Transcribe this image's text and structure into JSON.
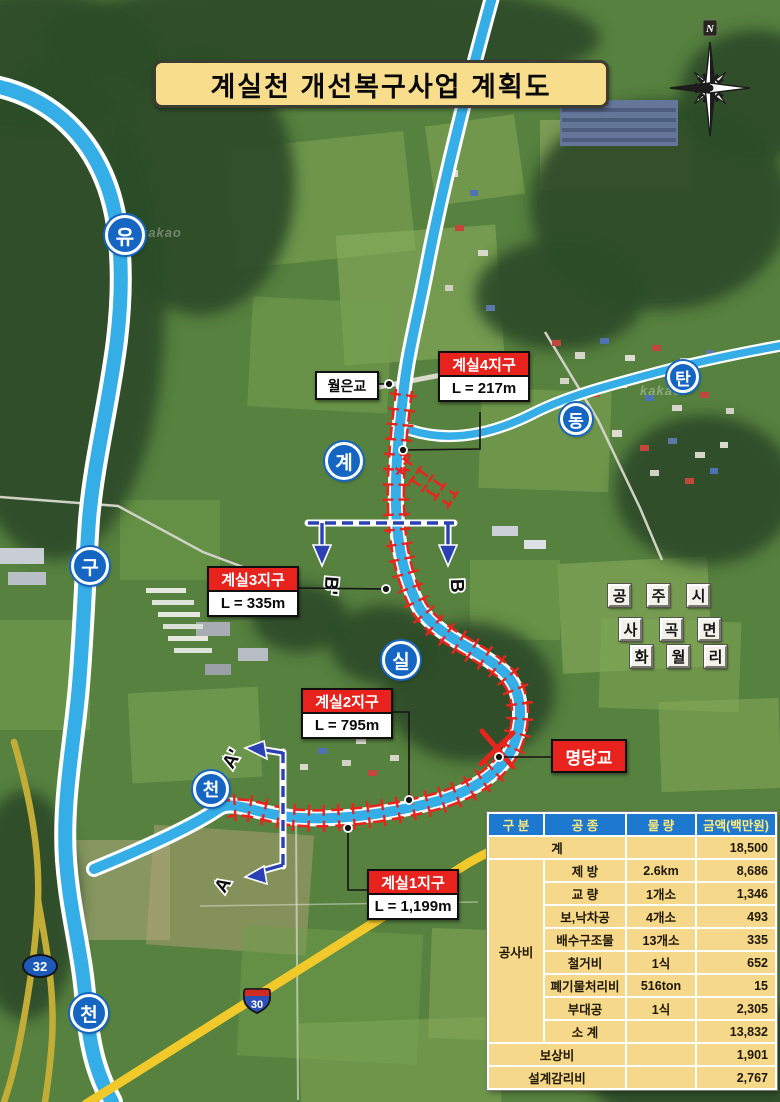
{
  "title": "계실천 개선복구사업 계획도",
  "compass": {
    "north": "N"
  },
  "bridges": {
    "woleun": "월은교",
    "myeongdang": "명당교"
  },
  "sections": [
    {
      "name": "계실4지구",
      "length": "L = 217m"
    },
    {
      "name": "계실3지구",
      "length": "L = 335m"
    },
    {
      "name": "계실2지구",
      "length": "L = 795m"
    },
    {
      "name": "계실1지구",
      "length": "L = 1,199m"
    }
  ],
  "section_markers": {
    "a": "A",
    "a_prime": "A'",
    "b": "B",
    "b_prime": "B'"
  },
  "stream_labels": {
    "left": [
      "유",
      "구",
      "천"
    ],
    "main": [
      "계",
      "실",
      "천"
    ],
    "east": [
      "동",
      "탄"
    ]
  },
  "region": {
    "row1": [
      "공",
      "주",
      "시"
    ],
    "row2": [
      "사",
      "곡",
      "면"
    ],
    "row3": [
      "화",
      "월",
      "리"
    ]
  },
  "routes": {
    "route32": "32",
    "route30": "30"
  },
  "watermark": "kakao",
  "colors": {
    "river": "#35ade7",
    "levee_red": "#e8251d",
    "section_blue": "#2a41b4",
    "table_header_bg": "#1d79cf",
    "table_header_text": "#ffe97c",
    "table_body_bg": "#f5d88a",
    "title_bg": "#f7dd8c",
    "label_red": "#e8231d"
  },
  "table": {
    "headers": [
      "구 분",
      "공 종",
      "물 량",
      "금액(백만원)"
    ],
    "rows": [
      {
        "category": "계",
        "item": "",
        "qty": "",
        "amount": "18,500"
      },
      {
        "category": "공사비",
        "item": "제 방",
        "qty": "2.6km",
        "amount": "8,686"
      },
      {
        "category": "",
        "item": "교 량",
        "qty": "1개소",
        "amount": "1,346"
      },
      {
        "category": "",
        "item": "보,낙차공",
        "qty": "4개소",
        "amount": "493"
      },
      {
        "category": "",
        "item": "배수구조물",
        "qty": "13개소",
        "amount": "335"
      },
      {
        "category": "",
        "item": "철거비",
        "qty": "1식",
        "amount": "652"
      },
      {
        "category": "",
        "item": "폐기물처리비",
        "qty": "516ton",
        "amount": "15"
      },
      {
        "category": "",
        "item": "부대공",
        "qty": "1식",
        "amount": "2,305"
      },
      {
        "category": "",
        "item": "소 계",
        "qty": "",
        "amount": "13,832"
      },
      {
        "category": "보상비",
        "item": "",
        "qty": "",
        "amount": "1,901"
      },
      {
        "category": "설계감리비",
        "item": "",
        "qty": "",
        "amount": "2,767"
      }
    ]
  }
}
